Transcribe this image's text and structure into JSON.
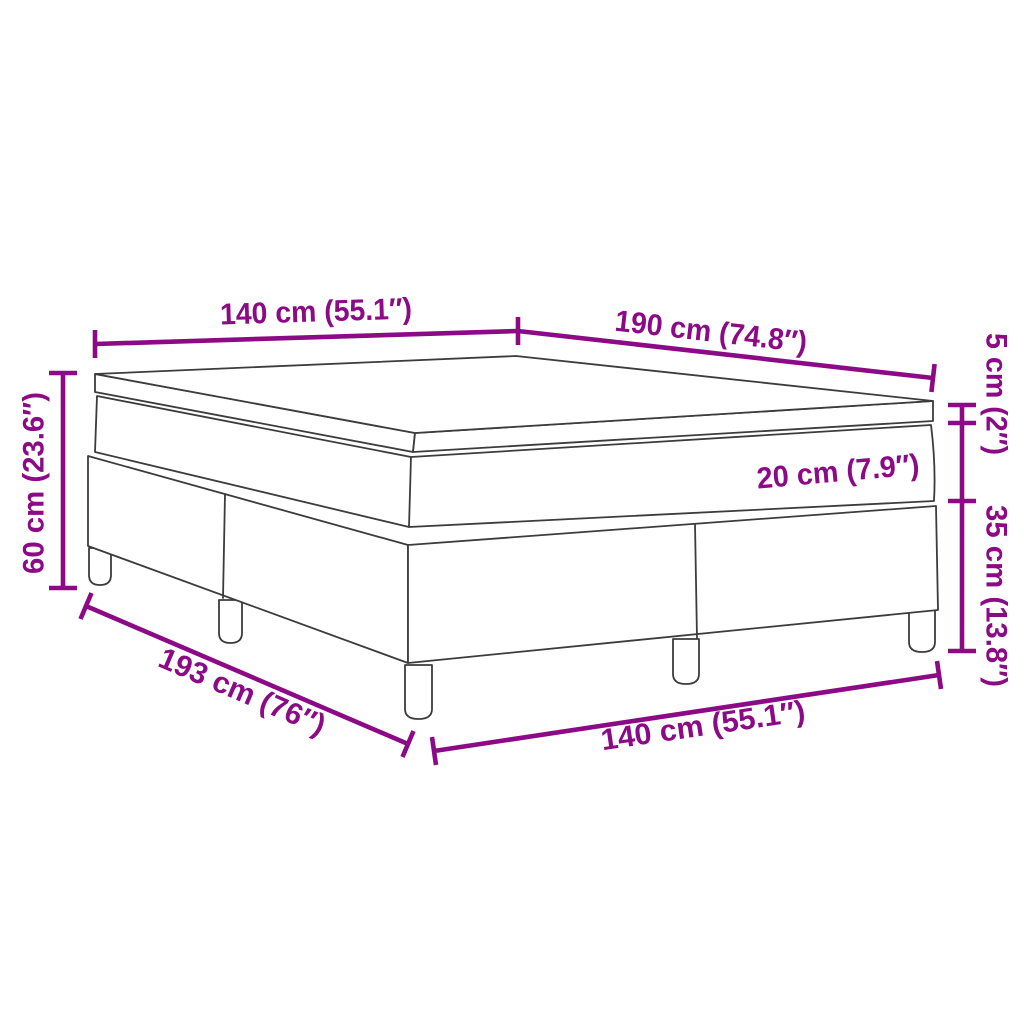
{
  "diagram": {
    "type": "product-dimension-line-drawing",
    "labels": {
      "width_top": "140 cm (55.1″)",
      "length_top": "190 cm (74.8″)",
      "topper_height": "5 cm (2″)",
      "mattress_height": "20 cm (7.9″)",
      "base_height": "35 cm (13.8″)",
      "total_height": "60 cm (23.6″)",
      "base_length_bottom": "193 cm (76″)",
      "width_bottom": "140 cm (55.1″)"
    },
    "colors": {
      "dimension_accent": "#8c0a86",
      "line_art": "#3c3c3c",
      "background": "#ffffff"
    }
  }
}
